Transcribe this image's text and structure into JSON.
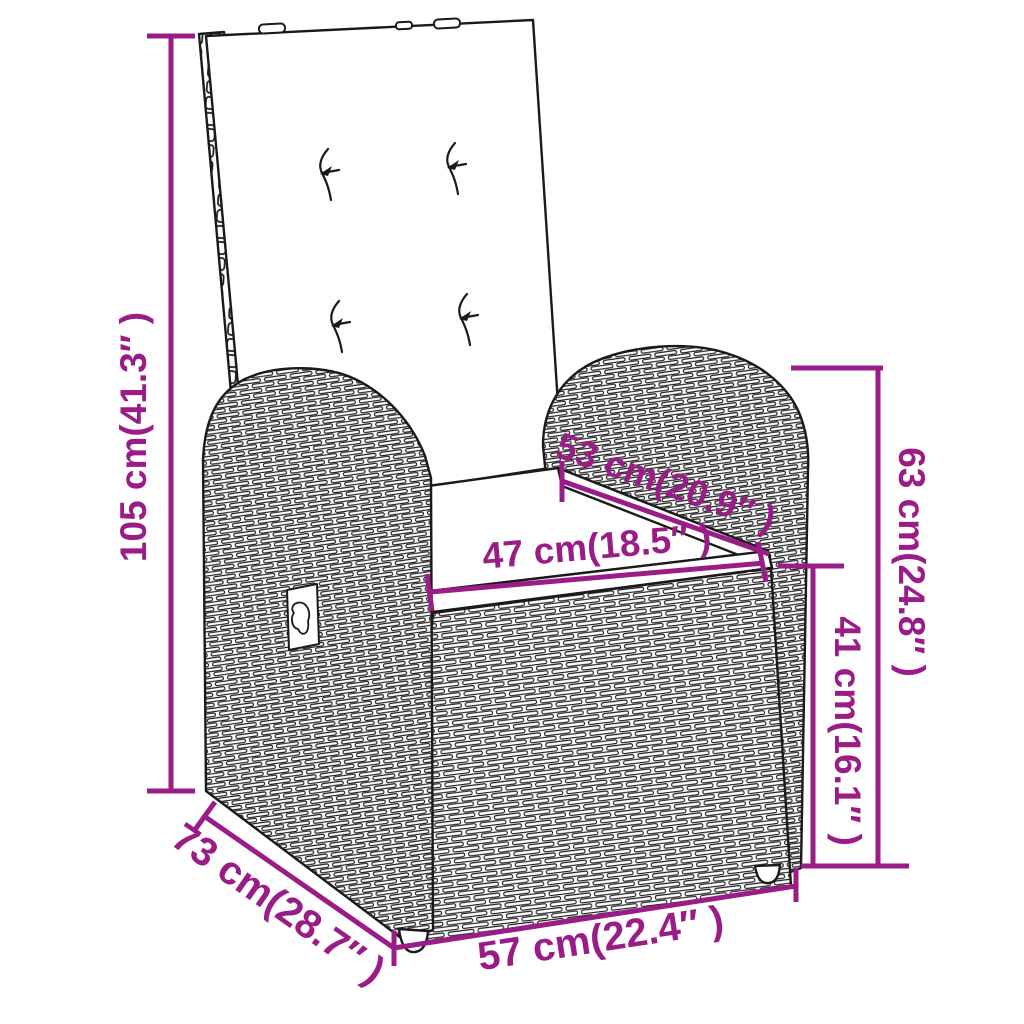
{
  "accent_color": "#9A1C86",
  "outline_color": "#1a1a1a",
  "dims": {
    "total_height": {
      "label": "105 cm(41.3″ )"
    },
    "total_depth": {
      "label": "73 cm(28.7″ )"
    },
    "total_width": {
      "label": "57 cm(22.4″ )"
    },
    "seat_width": {
      "label": "47 cm(18.5″ )"
    },
    "seat_depth": {
      "label": "53 cm(20.9″ )"
    },
    "armrest_height": {
      "label": "63 cm(24.8″ )"
    },
    "seat_height": {
      "label": "41 cm(16.1″ )"
    }
  }
}
